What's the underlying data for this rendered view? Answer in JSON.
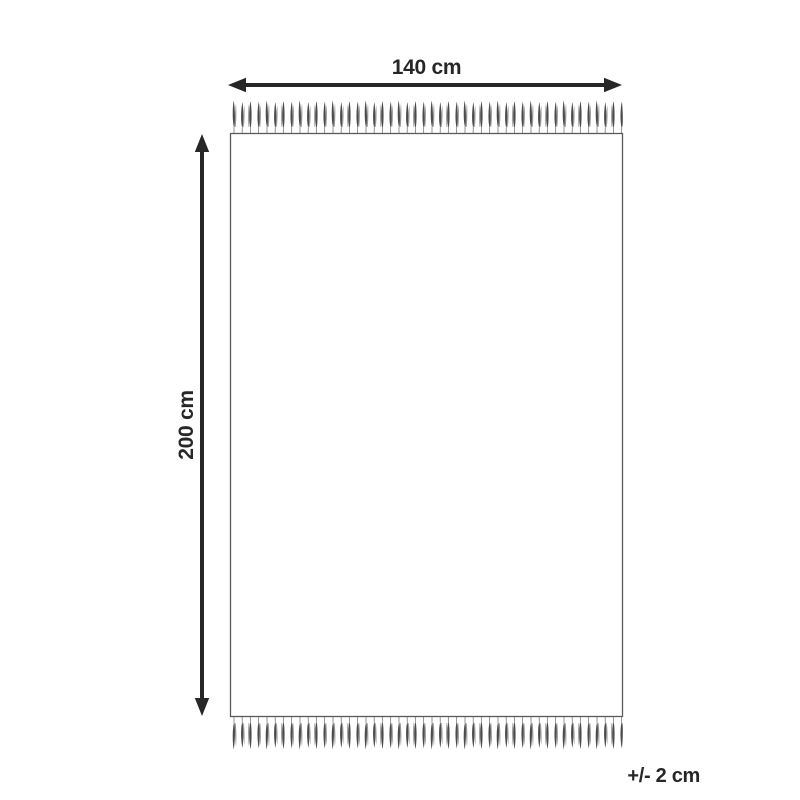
{
  "diagram": {
    "product": "fringed-rug-dimension-diagram",
    "width_label": "140 cm",
    "height_label": "200 cm",
    "tolerance_label": "+/- 2 cm",
    "colors": {
      "background": "#ffffff",
      "arrow_and_text": "#272727",
      "rug_border": "#5a5a5a",
      "rug_fill": "#ffffff",
      "fringe_dark": "#4c4c4c",
      "fringe_light": "#969696",
      "fringe_thread": "#8a8a8a"
    }
  }
}
